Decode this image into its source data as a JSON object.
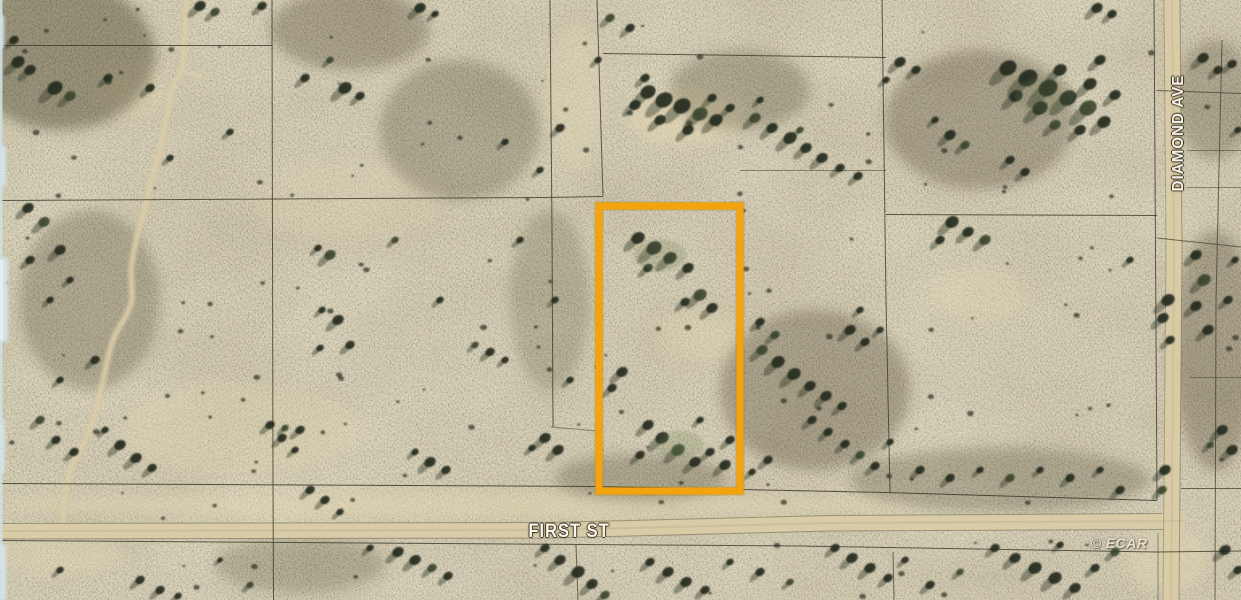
{
  "map": {
    "type": "satellite-aerial-parcel-view",
    "labels": {
      "street_horizontal": "FIRST ST",
      "street_vertical": "DIAMOND AVE",
      "watermark": "© ECAR"
    },
    "highlight_parcel": {
      "x": 599,
      "y": 206,
      "width": 141,
      "height": 285,
      "color": "#f2a30d"
    },
    "colors": {
      "terrain_base": "#b3a98b",
      "road": "#d9cca7",
      "parcel_grid_line": "#3a382b",
      "label_text": "#faf6ec",
      "edge_artifact_blue": "#cfdfe4",
      "bush_dark": "#232a1c"
    }
  }
}
